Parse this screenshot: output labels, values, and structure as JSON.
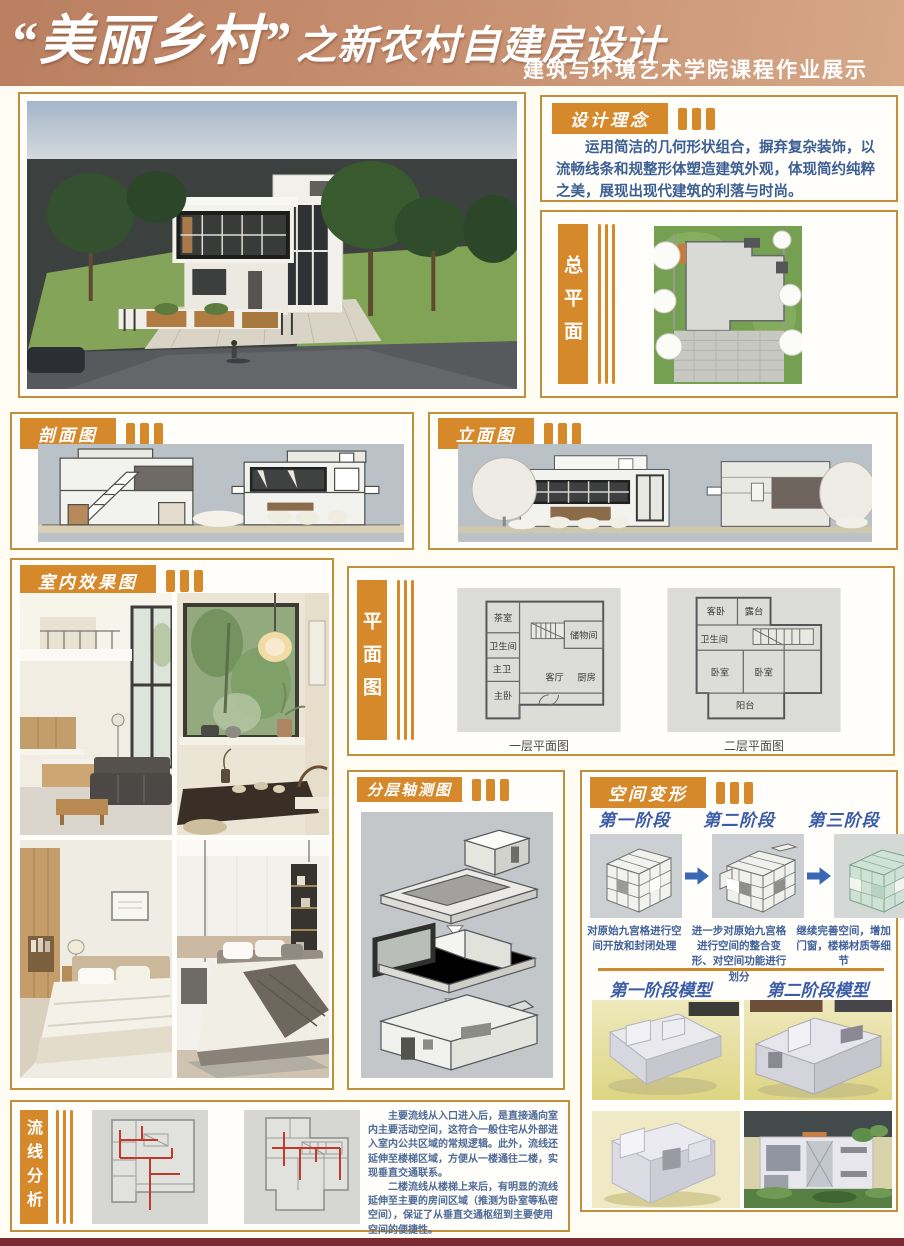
{
  "colors": {
    "accent_orange": "#d6892b",
    "border_gold": "#c28f3c",
    "body_text_blue": "#3c5f93",
    "stage_title_blue": "#3b5ca8",
    "header_tan": "#c99272",
    "footer_maroon": "#7c2b33"
  },
  "header": {
    "title_main": "“美丽乡村”",
    "title_rest": "之新农村自建房设计",
    "subtitle": "建筑与环境艺术学院课程作业展示"
  },
  "concept": {
    "label": "设计理念",
    "body": "运用简洁的几何形状组合，摒弃复杂装饰，以流畅线条和规整形体塑造建筑外观，体现简约纯粹之美，展现出现代建筑的利落与时尚。"
  },
  "site_plan": {
    "label": "总平面图"
  },
  "section_drawing": {
    "label": "剖面图"
  },
  "elevation": {
    "label": "立面图"
  },
  "interior": {
    "label": "室内效果图"
  },
  "floor_plan": {
    "label": "平面图",
    "plan1": {
      "caption": "一层平面图",
      "rooms": {
        "tea_room": "茶室",
        "bathroom": "卫生间",
        "master_bath": "主卫",
        "master_bedroom": "主卧",
        "living_room": "客厅",
        "kitchen": "厨房",
        "storage": "储物间"
      }
    },
    "plan2": {
      "caption": "二层平面图",
      "rooms": {
        "guest_bedroom": "客卧",
        "terrace": "露台",
        "bathroom": "卫生间",
        "bedroom_a": "卧室",
        "bedroom_b": "卧室",
        "balcony": "阳台"
      }
    }
  },
  "axonometric": {
    "label": "分层轴测图"
  },
  "transformation": {
    "label": "空间变形",
    "stages": [
      {
        "title": "第一阶段",
        "caption": "对原始九宫格进行空间开放和封闭处理"
      },
      {
        "title": "第二阶段",
        "caption": "进一步对原始九宫格进行空间的整合变形、对空间功能进行划分"
      },
      {
        "title": "第三阶段",
        "caption": "继续完善空间，增加门窗，楼梯材质等细节"
      }
    ],
    "models": [
      {
        "title": "第一阶段模型"
      },
      {
        "title": "第二阶段模型"
      }
    ]
  },
  "circulation": {
    "label": "流线分析",
    "paragraph1": "主要流线从入口进入后，是直接通向室内主要活动空间，这符合一般住宅从外部进入室内公共区域的常规逻辑。此外，流线还延伸至楼梯区域，方便从一楼通往二楼，实现垂直交通联系。",
    "paragraph2": "二楼流线从楼梯上来后，有明显的流线延伸至主要的房间区域（推测为卧室等私密空间），保证了从垂直交通枢纽到主要使用空间的便捷性。"
  }
}
